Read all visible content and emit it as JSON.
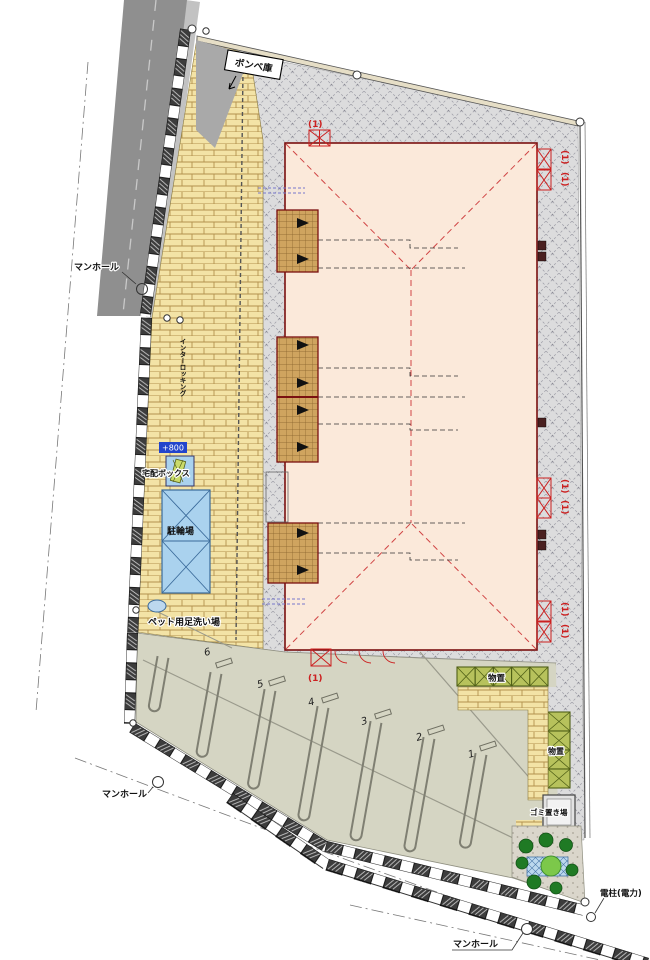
{
  "drawing": {
    "labels": {
      "manhole": "マンホール",
      "cylinder_store": "ボンベ庫",
      "delivery_box": "宅配ボックス",
      "level_mark": "+800",
      "bicycle_parking": "駐輪場",
      "pet_wash": "ペット用足洗い場",
      "storage": "物置",
      "garbage": "ゴミ置き場",
      "power_pole": "電柱(電力)",
      "unit_mark": "(1)",
      "paving_note": "インターロッキング"
    },
    "parking": {
      "stalls": [
        "6",
        "5",
        "4",
        "3",
        "2",
        "1"
      ]
    },
    "colors": {
      "road": "#8f8f8f",
      "paving": "#f3e3a6",
      "gravel": "#dedede",
      "building": "#fbe9da",
      "building_border": "#7a1010",
      "porch": "#cfa45f",
      "parking": "#d5d5c3",
      "bicycle": "#aad2ee",
      "storage": "#b7c25c",
      "tree": "#1f7a24",
      "marker_red": "#cc2020",
      "level_blue": "#2244cc"
    }
  }
}
